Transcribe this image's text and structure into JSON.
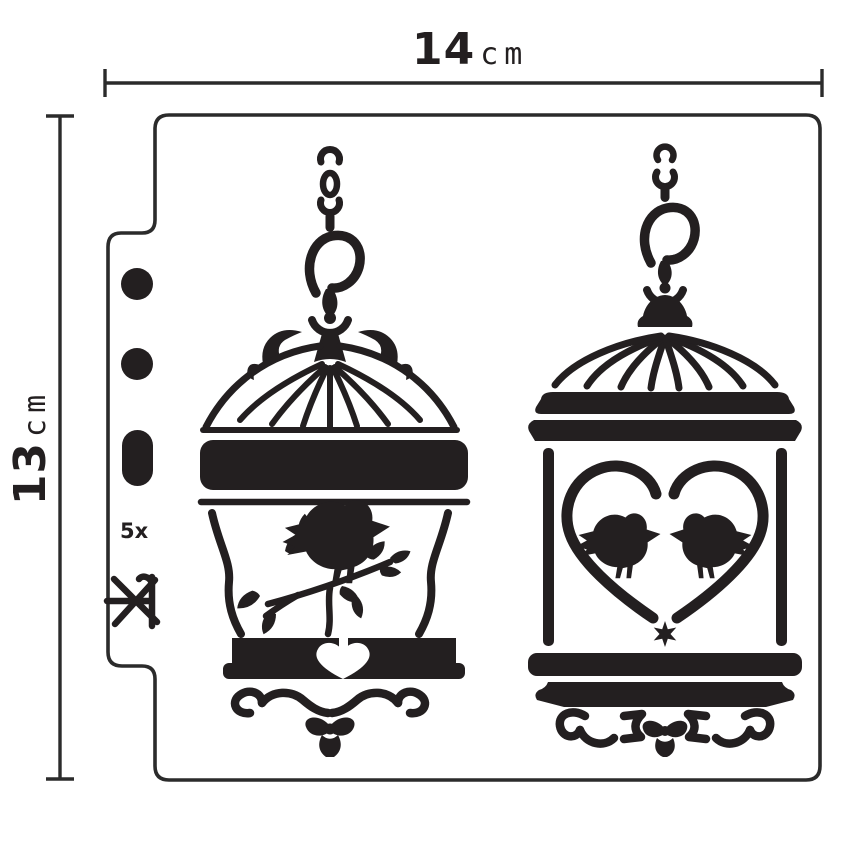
{
  "image": {
    "background": "#ffffff",
    "ink_color": "#231f20",
    "outline_color": "#2b2b2b"
  },
  "dimensions": {
    "width": {
      "value": "14",
      "unit": "cm"
    },
    "height": {
      "value": "13",
      "unit": "cm"
    }
  },
  "stencil": {
    "code": "5x",
    "designs": [
      {
        "name": "hanging-birdcage-with-bird-on-branch"
      },
      {
        "name": "hanging-birdcage-with-heart-and-lovebirds"
      }
    ],
    "registration_marks": [
      "round-hole",
      "round-hole",
      "slot-hole",
      "code-label",
      "asterisk-mark"
    ]
  }
}
